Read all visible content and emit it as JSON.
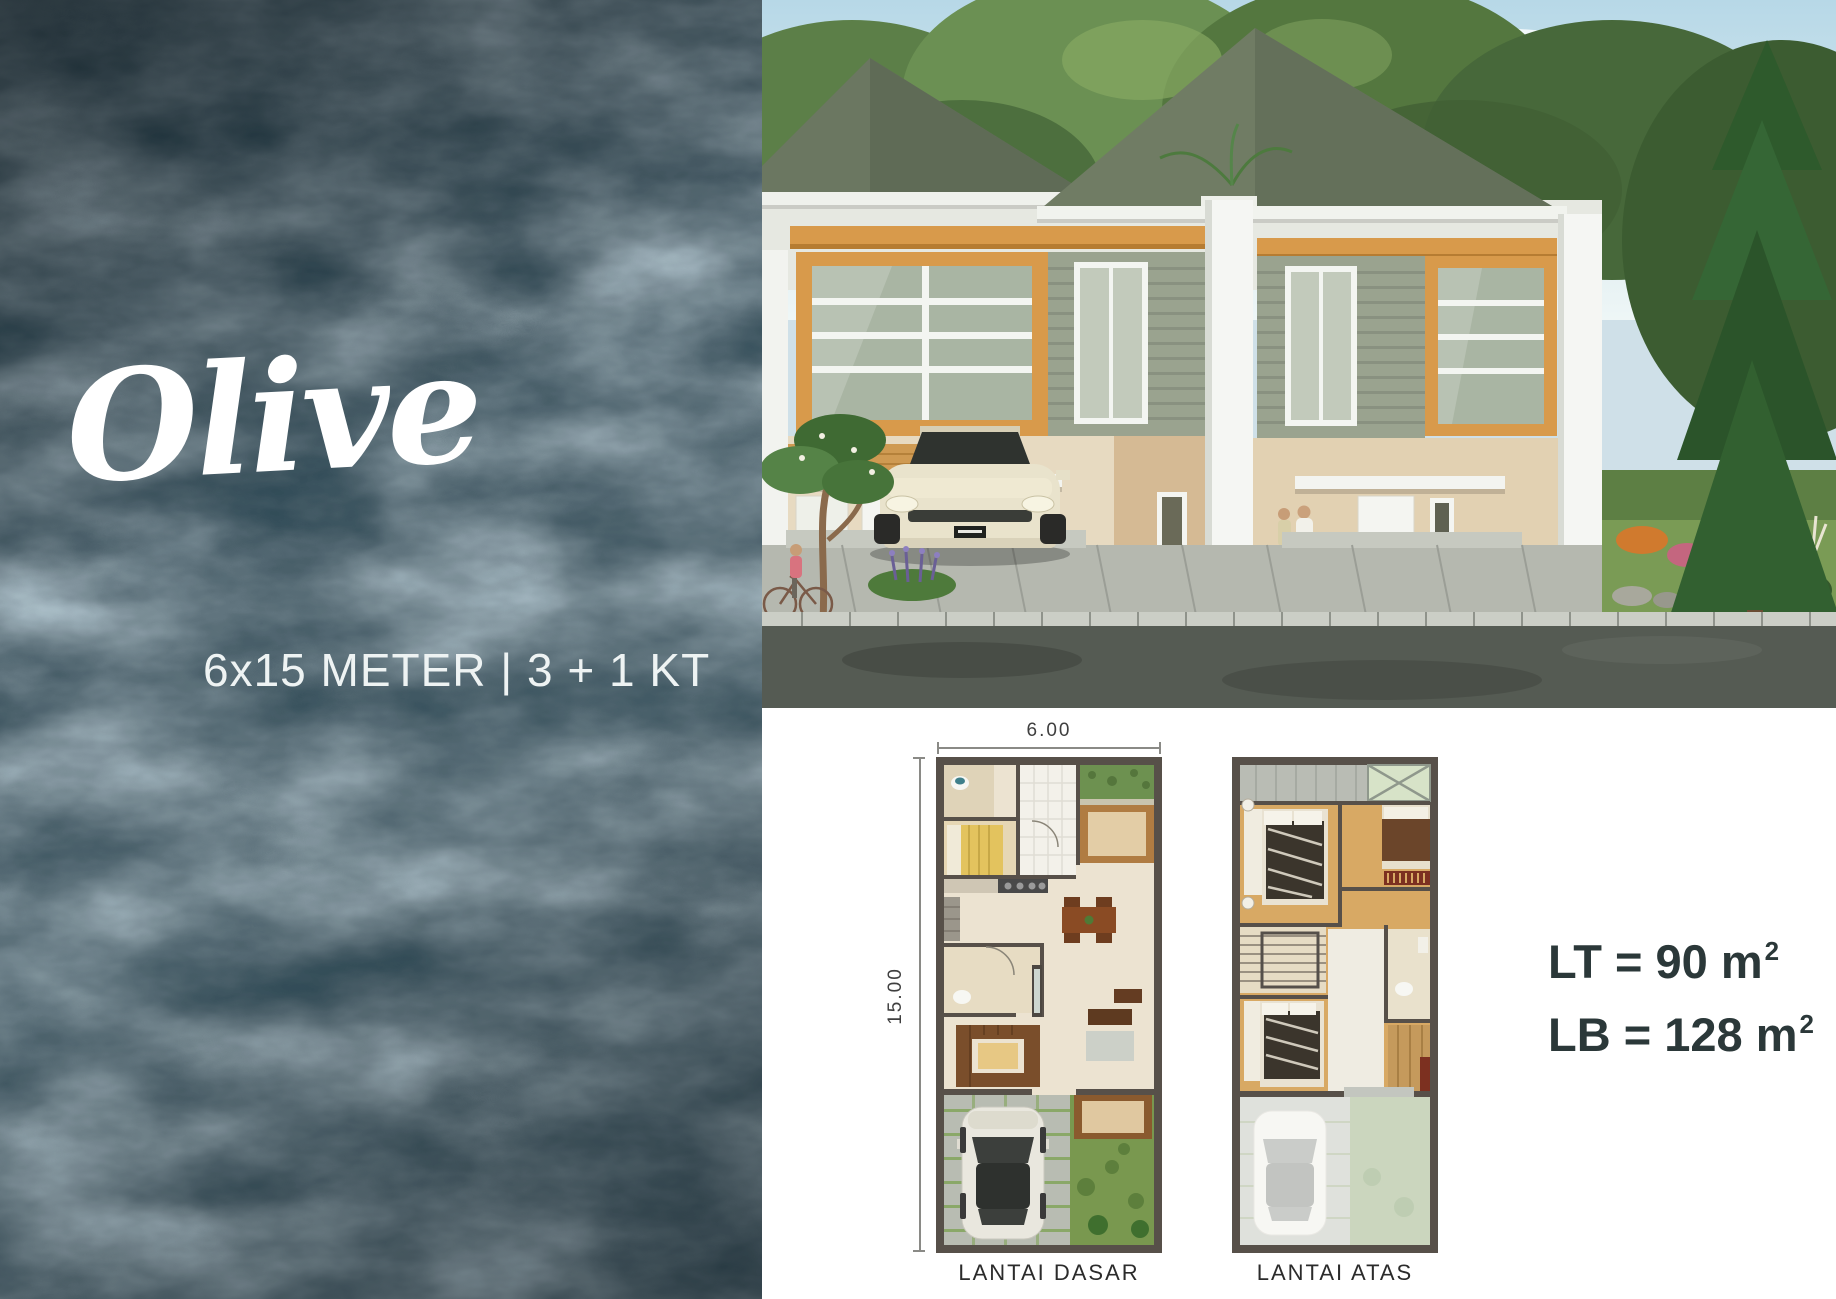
{
  "hero": {
    "title": "Olive",
    "subtitle": "6x15 METER | 3 + 1 KT"
  },
  "specs": {
    "lines": [
      {
        "text": "LT = 90 m",
        "sup": "2"
      },
      {
        "text": "LB = 128 m",
        "sup": "2"
      }
    ]
  },
  "floorplans": {
    "width_label": "6.00",
    "height_label": "15.00",
    "plans": [
      {
        "caption": "LANTAI DASAR"
      },
      {
        "caption": "LANTAI ATAS"
      }
    ]
  },
  "colors": {
    "marble_base": "#0e1c24",
    "accent_wood": "#d89a4b",
    "roof": "#6d7a64",
    "spec_text": "#2b3839",
    "plan_wall": "#575049"
  }
}
